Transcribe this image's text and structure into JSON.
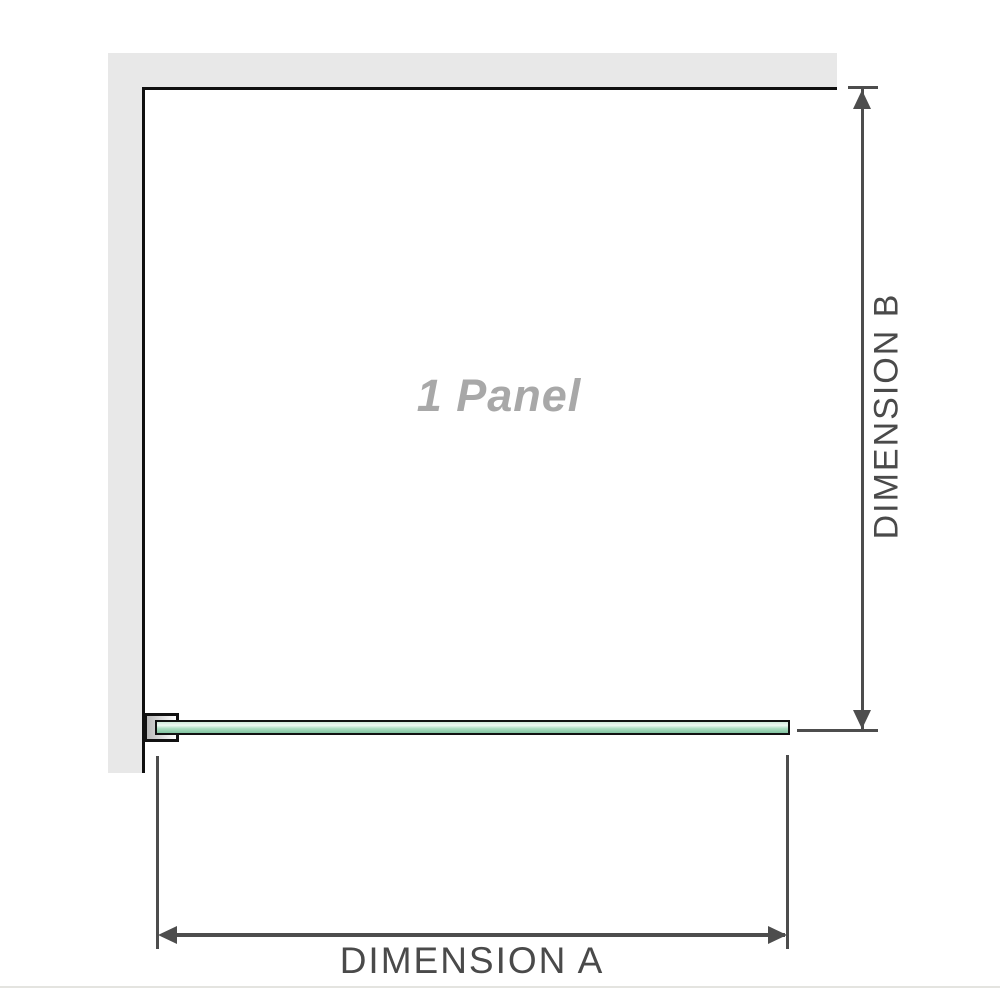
{
  "diagram": {
    "panel_label": "1 Panel",
    "dimensions": {
      "a": {
        "label": "DIMENSION A"
      },
      "b": {
        "label": "DIMENSION B"
      }
    },
    "colors": {
      "wall_fill": "#e8e8e8",
      "wall_edge": "#101010",
      "glass_border": "#111111",
      "glass_green": "#aadcc0",
      "glass_green_dark": "#82c4a0",
      "glass_highlight": "#eef8f2",
      "bracket_silver": "#b9b9b9",
      "dimension_line": "#4d4d4d",
      "dimension_text": "#4a4a4a",
      "panel_label_gray": "#a8a8a8",
      "footer_line": "#e4e4e0"
    }
  }
}
